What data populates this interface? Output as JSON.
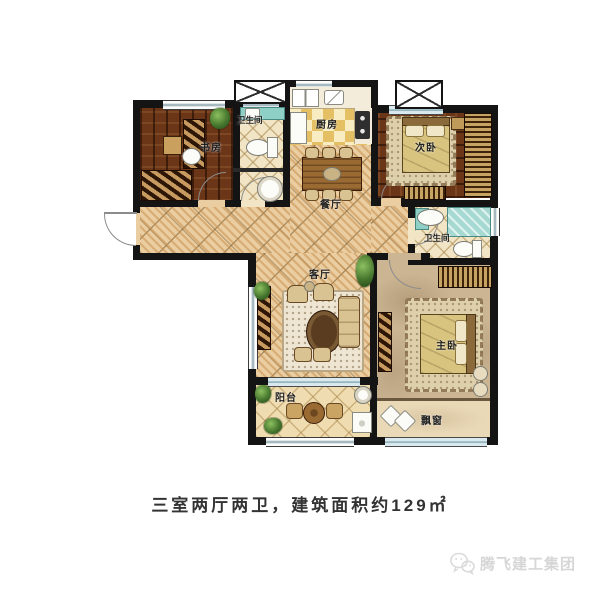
{
  "meta": {
    "caption": "三室两厅两卫，建筑面积约129㎡",
    "watermark_text": "腾飞建工集团"
  },
  "rooms": {
    "study": {
      "label": "书房",
      "fixtures": [
        "desk",
        "desk-chair",
        "wall-cabinet",
        "daybed",
        "plant",
        "window"
      ]
    },
    "bath1": {
      "label": "卫生间",
      "fixtures": [
        "vanity-counter",
        "sink",
        "toilet",
        "pedestal-basin",
        "window"
      ]
    },
    "kitchen": {
      "label": "厨房",
      "fixtures": [
        "double-sink",
        "cutting-board",
        "stove",
        "counters",
        "window"
      ]
    },
    "dining": {
      "label": "餐厅",
      "fixtures": [
        "dining-table",
        "six-chairs"
      ]
    },
    "bedroom2": {
      "label": "次卧",
      "fixtures": [
        "bed",
        "pillows",
        "rug",
        "wardrobe",
        "tv-bench",
        "nightstand",
        "window",
        "ac-platform"
      ]
    },
    "bath2": {
      "label": "卫生间",
      "fixtures": [
        "sink",
        "shower",
        "toilet",
        "window"
      ]
    },
    "living": {
      "label": "客厅",
      "fixtures": [
        "sofa",
        "armchairs",
        "coffee-table",
        "rug",
        "ottomans",
        "tv-cabinet",
        "plants",
        "balcony-slider"
      ]
    },
    "master": {
      "label": "主卧",
      "fixtures": [
        "bed",
        "pillows",
        "rug",
        "wardrobe",
        "tv-stand",
        "stools"
      ]
    },
    "balcony": {
      "label": "阳台",
      "fixtures": [
        "round-table",
        "two-chairs",
        "wash-basin",
        "washing-machine",
        "plants",
        "railing-window"
      ]
    },
    "bay_window": {
      "label": "飘窗",
      "fixtures": [
        "cushions",
        "window-band"
      ]
    }
  },
  "colors": {
    "wall": "#141414",
    "wood_floor": "#6b3518",
    "weave_tile": "#eacda0",
    "kitchen_tile": "#e4bf64",
    "bath_tile": "#f1e5c6",
    "master_floor": "#cbb593",
    "teal_fixture": "#8ecfc6",
    "window_glass": "#a2b6bd",
    "caption_text": "#333333",
    "watermark_gray": "#d6d6d6"
  }
}
